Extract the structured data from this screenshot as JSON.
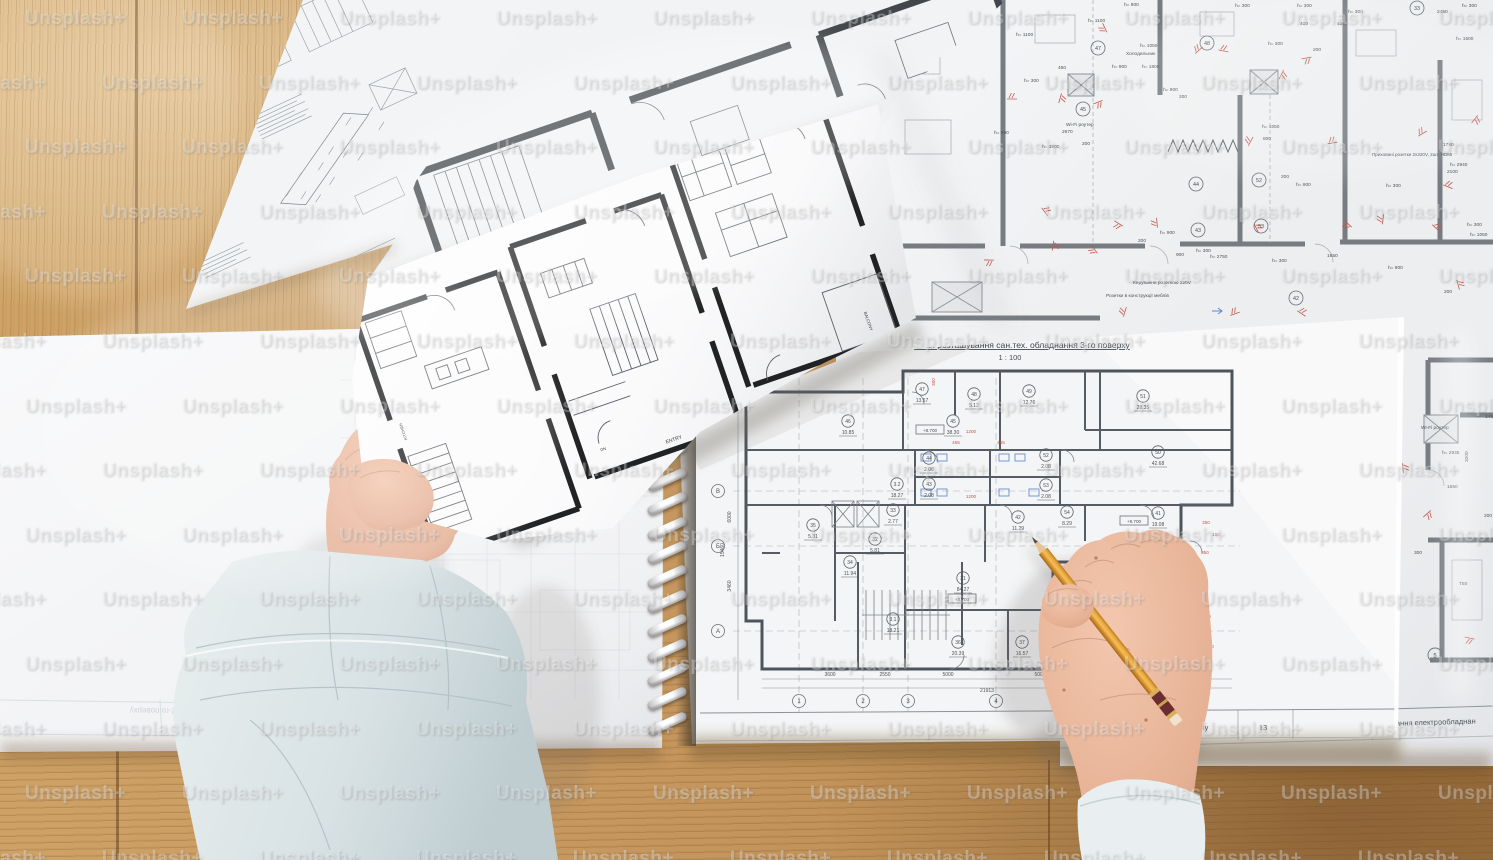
{
  "scene": {
    "width": 1493,
    "height": 860,
    "description": "top-down photo of architectural blueprints on wooden table, two hands, pencil"
  },
  "watermark": {
    "text": "Unsplash+"
  },
  "notebook": {
    "title": "План розташування сан.тех. обладнання 3-го поверху",
    "scale": "1 : 100",
    "footer_cell": "га поверху",
    "page_number": "13",
    "rooms": [
      {
        "n": "47",
        "a": "13.57",
        "x": 922,
        "y": 392
      },
      {
        "n": "48",
        "a": "5.12",
        "x": 974,
        "y": 397
      },
      {
        "n": "49",
        "a": "12.76",
        "x": 1029,
        "y": 394
      },
      {
        "n": "51",
        "a": "28.35",
        "x": 1143,
        "y": 399
      },
      {
        "n": "46",
        "a": "10.85",
        "x": 848,
        "y": 424
      },
      {
        "n": "45",
        "a": "38.30",
        "x": 953,
        "y": 424
      },
      {
        "n": "44",
        "a": "2.08",
        "x": 929,
        "y": 461
      },
      {
        "n": "43",
        "a": "2.08",
        "x": 929,
        "y": 487
      },
      {
        "n": "52",
        "a": "2.08",
        "x": 1046,
        "y": 458
      },
      {
        "n": "53",
        "a": "2.08",
        "x": 1046,
        "y": 488
      },
      {
        "n": "50",
        "a": "42.68",
        "x": 1158,
        "y": 455
      },
      {
        "n": "3.2",
        "a": "18.27",
        "x": 897,
        "y": 487
      },
      {
        "n": "33",
        "a": "2.77",
        "x": 893,
        "y": 513
      },
      {
        "n": "35",
        "a": "5.31",
        "x": 813,
        "y": 528
      },
      {
        "n": "32",
        "a": "5.81",
        "x": 875,
        "y": 542
      },
      {
        "n": "34",
        "a": "11.94",
        "x": 850,
        "y": 565
      },
      {
        "n": "42",
        "a": "11.29",
        "x": 1018,
        "y": 520
      },
      {
        "n": "54",
        "a": "8.29",
        "x": 1067,
        "y": 515
      },
      {
        "n": "41",
        "a": "19.08",
        "x": 1158,
        "y": 516
      },
      {
        "n": "31",
        "a": "84.27",
        "x": 963,
        "y": 581
      },
      {
        "n": "3.1",
        "a": "18.21",
        "x": 893,
        "y": 622
      },
      {
        "n": "36",
        "a": "20.39",
        "x": 958,
        "y": 645
      },
      {
        "n": "37",
        "a": "16.57",
        "x": 1022,
        "y": 645
      }
    ],
    "level_boxes": [
      {
        "t": "+8.700",
        "x": 930,
        "y": 430
      },
      {
        "t": "+8.700",
        "x": 1134,
        "y": 521
      },
      {
        "t": "+8.700",
        "x": 962,
        "y": 599
      }
    ],
    "row_axes": [
      {
        "t": "В",
        "x": 718,
        "y": 491
      },
      {
        "t": "Б",
        "x": 718,
        "y": 546
      },
      {
        "t": "А",
        "x": 718,
        "y": 631
      }
    ],
    "col_axes": [
      {
        "t": "1",
        "x": 799,
        "y": 701
      },
      {
        "t": "2",
        "x": 863,
        "y": 701
      },
      {
        "t": "3",
        "x": 908,
        "y": 701
      },
      {
        "t": "4",
        "x": 996,
        "y": 701
      }
    ],
    "dims": [
      {
        "t": "3600",
        "x": 830,
        "y": 676
      },
      {
        "t": "2550",
        "x": 885,
        "y": 676
      },
      {
        "t": "5000",
        "x": 948,
        "y": 676
      },
      {
        "t": "5000",
        "x": 1040,
        "y": 676
      },
      {
        "t": "21913",
        "x": 987,
        "y": 692
      },
      {
        "t": "6000",
        "x": 731,
        "y": 517,
        "r": -90
      },
      {
        "t": "3460",
        "x": 731,
        "y": 586,
        "r": -90
      },
      {
        "t": "15460",
        "x": 724,
        "y": 550,
        "r": -90
      }
    ],
    "red_marks": [
      {
        "t": "1200",
        "x": 971,
        "y": 433
      },
      {
        "t": "455",
        "x": 956,
        "y": 444
      },
      {
        "t": "455",
        "x": 1001,
        "y": 444
      },
      {
        "t": "1200",
        "x": 971,
        "y": 498
      },
      {
        "t": "300",
        "x": 935,
        "y": 382,
        "r": -90
      },
      {
        "t": "350",
        "x": 1206,
        "y": 524
      },
      {
        "t": "150",
        "x": 1216,
        "y": 536
      },
      {
        "t": "350",
        "x": 1205,
        "y": 554
      },
      {
        "t": "350",
        "x": 1207,
        "y": 618
      },
      {
        "t": "350",
        "x": 1210,
        "y": 648
      }
    ]
  },
  "electrical": {
    "footer_text": "вання електрообладнан",
    "axis5": {
      "t": "5",
      "x": 1435,
      "y": 655
    },
    "labels": [
      {
        "t": "h= 1100",
        "x": 1016,
        "y": 36
      },
      {
        "t": "h= 1100",
        "x": 1088,
        "y": 22
      },
      {
        "t": "450",
        "x": 1058,
        "y": 69
      },
      {
        "t": "h= 300",
        "x": 1024,
        "y": 82
      },
      {
        "t": "h= 1050",
        "x": 1140,
        "y": 47
      },
      {
        "t": "Холодильник",
        "x": 1126,
        "y": 55
      },
      {
        "t": "h= 900",
        "x": 1112,
        "y": 68
      },
      {
        "t": "h= 1800",
        "x": 1142,
        "y": 68
      },
      {
        "t": "h= 900",
        "x": 1163,
        "y": 91
      },
      {
        "t": "200",
        "x": 1179,
        "y": 98
      },
      {
        "t": "h= 900",
        "x": 1124,
        "y": 6
      },
      {
        "t": "h= 300",
        "x": 1235,
        "y": 7
      },
      {
        "t": "h= 300",
        "x": 1297,
        "y": 7
      },
      {
        "t": "400",
        "x": 1300,
        "y": 25
      },
      {
        "t": "400",
        "x": 1337,
        "y": 25
      },
      {
        "t": "200",
        "x": 1313,
        "y": 51
      },
      {
        "t": "h= 300",
        "x": 1268,
        "y": 45
      },
      {
        "t": "h= 300",
        "x": 1348,
        "y": 13
      },
      {
        "t": "h= 300",
        "x": 1462,
        "y": 7
      },
      {
        "t": "2450",
        "x": 1437,
        "y": 13
      },
      {
        "t": "h= 1500",
        "x": 1456,
        "y": 40
      },
      {
        "t": "Wi-Fi роутер",
        "x": 1066,
        "y": 126
      },
      {
        "t": "2670",
        "x": 1062,
        "y": 133
      },
      {
        "t": "h= 900",
        "x": 994,
        "y": 134
      },
      {
        "t": "h= 1800",
        "x": 1042,
        "y": 148
      },
      {
        "t": "200",
        "x": 1082,
        "y": 145
      },
      {
        "t": "h= 1050",
        "x": 1262,
        "y": 128
      },
      {
        "t": "800",
        "x": 1263,
        "y": 140
      },
      {
        "t": "Приховані розетки 2x220V, 2шт, HDMI",
        "x": 1372,
        "y": 156,
        "s": 4.6
      },
      {
        "t": "1790",
        "x": 1443,
        "y": 146
      },
      {
        "t": "h= 2940",
        "x": 1450,
        "y": 166
      },
      {
        "t": "2100",
        "x": 1447,
        "y": 173
      },
      {
        "t": "h= 300",
        "x": 1386,
        "y": 187
      },
      {
        "t": "h= 900",
        "x": 1296,
        "y": 186
      },
      {
        "t": "200",
        "x": 1281,
        "y": 178
      },
      {
        "t": "h= 300",
        "x": 1467,
        "y": 226
      },
      {
        "t": "h= 1050",
        "x": 1470,
        "y": 236
      },
      {
        "t": "Керування розеткою 220V",
        "x": 1133,
        "y": 284,
        "s": 4.8
      },
      {
        "t": "Розетки в конструкції меблів",
        "x": 1106,
        "y": 297,
        "s": 4.8
      },
      {
        "t": "h= 300",
        "x": 1196,
        "y": 252
      },
      {
        "t": "h= 2750",
        "x": 1210,
        "y": 258
      },
      {
        "t": "900",
        "x": 1176,
        "y": 256
      },
      {
        "t": "h= 300",
        "x": 1272,
        "y": 262
      },
      {
        "t": "1650",
        "x": 1327,
        "y": 257
      },
      {
        "t": "h= 900",
        "x": 1388,
        "y": 269
      },
      {
        "t": "200",
        "x": 1444,
        "y": 293
      },
      {
        "t": "h= 900",
        "x": 1160,
        "y": 234
      },
      {
        "t": "200",
        "x": 1138,
        "y": 242
      },
      {
        "t": "Wi-Fi роутер",
        "x": 1421,
        "y": 429
      },
      {
        "t": "h= 2935",
        "x": 1442,
        "y": 454
      },
      {
        "t": "1550",
        "x": 1447,
        "y": 488
      },
      {
        "t": "200",
        "x": 1484,
        "y": 517
      },
      {
        "t": "300",
        "x": 1414,
        "y": 554
      },
      {
        "t": "T50",
        "x": 1459,
        "y": 585
      },
      {
        "t": "1430",
        "x": 1485,
        "y": 418
      },
      {
        "t": "3200",
        "x": 1468,
        "y": 462,
        "r": -90
      }
    ],
    "rooms": [
      {
        "n": "47",
        "x": 1098,
        "y": 48
      },
      {
        "n": "48",
        "x": 1207,
        "y": 43
      },
      {
        "n": "45",
        "x": 1083,
        "y": 109
      },
      {
        "n": "44",
        "x": 1196,
        "y": 184
      },
      {
        "n": "52",
        "x": 1259,
        "y": 180
      },
      {
        "n": "43",
        "x": 1198,
        "y": 230
      },
      {
        "n": "53",
        "x": 1261,
        "y": 226
      },
      {
        "n": "42",
        "x": 1296,
        "y": 298
      },
      {
        "n": "33",
        "x": 1417,
        "y": 8
      }
    ],
    "outlets": [
      [
        1012,
        96
      ],
      [
        1047,
        210
      ],
      [
        1063,
        99
      ],
      [
        1099,
        105
      ],
      [
        1117,
        226
      ],
      [
        1154,
        223
      ],
      [
        1197,
        48
      ],
      [
        1224,
        48
      ],
      [
        1259,
        227
      ],
      [
        1284,
        76
      ],
      [
        1307,
        61
      ],
      [
        1346,
        226
      ],
      [
        1380,
        219
      ],
      [
        1421,
        131
      ],
      [
        1449,
        184
      ],
      [
        1461,
        284
      ],
      [
        1477,
        121
      ],
      [
        989,
        263
      ],
      [
        1092,
        251
      ],
      [
        1122,
        311
      ],
      [
        1234,
        311
      ],
      [
        1303,
        311
      ],
      [
        1406,
        468
      ],
      [
        1429,
        516
      ],
      [
        1469,
        641
      ],
      [
        1102,
        29
      ],
      [
        1248,
        140
      ],
      [
        1332,
        140
      ],
      [
        1438,
        226
      ],
      [
        1056,
        246
      ]
    ],
    "blue_arrows": [
      [
        1218,
        311
      ]
    ]
  },
  "held_paper": {
    "labels": [
      {
        "t": "ENTRY",
        "x": 12,
        "y": 132,
        "s": 5,
        "r": 0
      },
      {
        "t": "BALCONY",
        "x": 233,
        "y": 82,
        "s": 4.2,
        "r": 90
      },
      {
        "t": "KITCHEN",
        "x": -240,
        "y": 35,
        "s": 4,
        "r": -90
      },
      {
        "t": "DN",
        "x": -58,
        "y": 118,
        "s": 4,
        "r": 0
      }
    ]
  },
  "left_sheet": {
    "ghost_title": "План розташування сан.тех. обладнання 2-го поверху"
  },
  "colors": {
    "wood": "#c99b62",
    "paper": "#f4f5f6",
    "plan_wall_grey": "#565c63",
    "plan_red": "#c2564a",
    "plan_blue": "#6b8fc9",
    "pencil_body": "#e5a33c",
    "pencil_band": "#6b2d2f",
    "pencil_ring": "#d8ae5e",
    "skin": "#e9b99f",
    "sleeve": "#dde6e8"
  }
}
